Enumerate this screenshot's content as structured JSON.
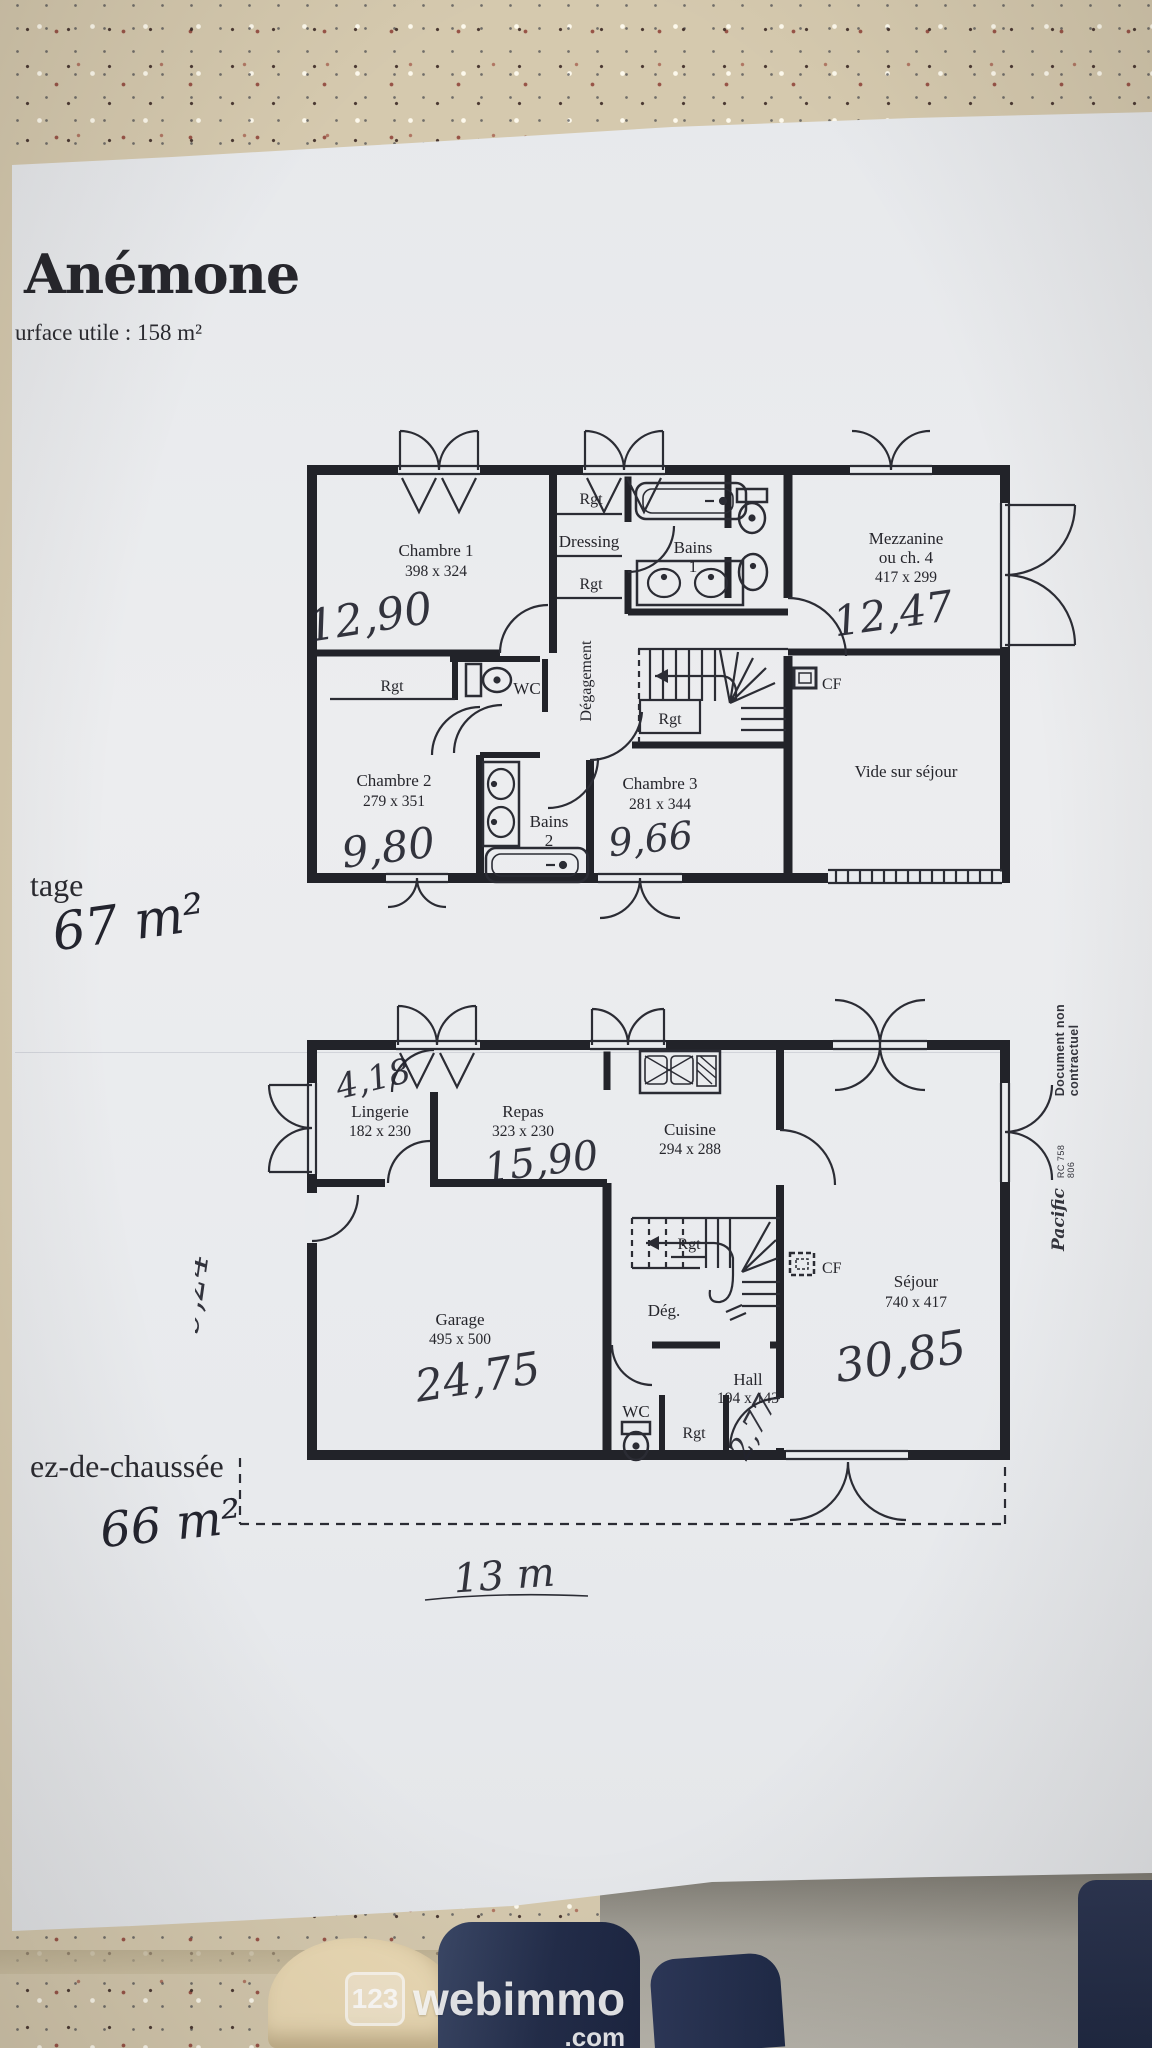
{
  "doc": {
    "title": "Anémone",
    "surface_note": "urface utile : 158 m²",
    "margin": {
      "brand": "Pacific",
      "reg": "RC 758 806",
      "disclaimer": "Document non contractuel"
    }
  },
  "etage": {
    "floor_label": "tage",
    "floor_area": "67 m²",
    "chambre1": {
      "name": "Chambre 1",
      "dims": "398 x 324",
      "area": "12,90"
    },
    "rgt_a": "Rgt",
    "dressing": "Dressing",
    "rgt_b": "Rgt",
    "bains1": {
      "name": "Bains",
      "num": "1"
    },
    "mezzanine": {
      "name": "Mezzanine",
      "alt": "ou ch. 4",
      "dims": "417 x 299",
      "area": "12,47"
    },
    "rgt_c": "Rgt",
    "wc": "WC",
    "degagement": "Dégagement",
    "rgt_d": "Rgt",
    "cf": "CF",
    "chambre2": {
      "name": "Chambre 2",
      "dims": "279 x 351",
      "area": "9,80"
    },
    "bains2": {
      "name": "Bains",
      "num": "2"
    },
    "chambre3": {
      "name": "Chambre 3",
      "dims": "281 x 344",
      "area": "9,66"
    },
    "vide": "Vide sur séjour"
  },
  "rdc": {
    "floor_label": "ez-de-chaussée",
    "floor_area": "66 m²",
    "dim_top": "4,18",
    "lingerie": {
      "name": "Lingerie",
      "dims": "182 x 230"
    },
    "repas": {
      "name": "Repas",
      "dims": "323 x 230",
      "area": "15,90"
    },
    "cuisine": {
      "name": "Cuisine",
      "dims": "294 x 288"
    },
    "garage": {
      "name": "Garage",
      "dims": "495 x 500",
      "area": "24,75"
    },
    "deg": "Dég.",
    "rgt_a": "Rgt",
    "cf": "CF",
    "sejour": {
      "name": "Séjour",
      "dims": "740 x 417",
      "area": "30,85"
    },
    "wc": "WC",
    "rgt_b": "Rgt",
    "hall": {
      "name": "Hall",
      "dims": "194 x 143",
      "area": "2,77"
    },
    "dim_left": "9,24",
    "dim_bottom": "13 m"
  },
  "watermark": {
    "badge": "123",
    "name": "webimmo",
    "tld": ".com"
  }
}
